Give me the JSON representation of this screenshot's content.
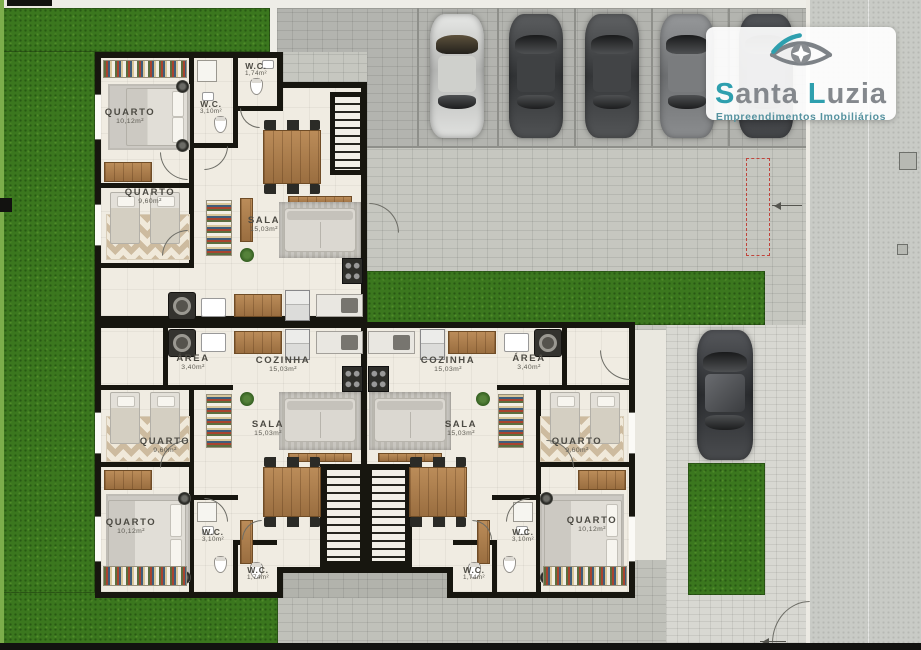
{
  "brand": {
    "word1": "Santa",
    "word2": "Luzia",
    "tagline": "Empreendimentos Imobiliários",
    "accent_color": "#2e9fae",
    "text_color": "#84888d"
  },
  "rooms": {
    "t_quarto1": {
      "name": "QUARTO",
      "area": "10,12m²"
    },
    "t_quarto2": {
      "name": "QUARTO",
      "area": "9,60m²"
    },
    "t_wc_small": {
      "name": "W.C.",
      "area": "1,74m²"
    },
    "t_wc_large": {
      "name": "W.C.",
      "area": "3,10m²"
    },
    "t_sala": {
      "name": "SALA",
      "area": "15,03m²"
    },
    "bl_area": {
      "name": "ÁREA",
      "area": "3,40m²"
    },
    "bl_cozinha": {
      "name": "COZINHA",
      "area": "15,03m²"
    },
    "bl_sala": {
      "name": "SALA",
      "area": "15,03m²"
    },
    "bl_quarto1": {
      "name": "QUARTO",
      "area": "9,60m²"
    },
    "bl_quarto2": {
      "name": "QUARTO",
      "area": "10,12m²"
    },
    "bl_wc_large": {
      "name": "W.C.",
      "area": "3,10m²"
    },
    "bl_wc_small": {
      "name": "W.C.",
      "area": "1,74m²"
    },
    "br_cozinha": {
      "name": "COZINHA",
      "area": "15,03m²"
    },
    "br_area": {
      "name": "ÁREA",
      "area": "3,40m²"
    },
    "br_sala": {
      "name": "SALA",
      "area": "15,03m²"
    },
    "br_quarto1": {
      "name": "QUARTO",
      "area": "9,60m²"
    },
    "br_quarto2": {
      "name": "QUARTO",
      "area": "10,12m²"
    },
    "br_wc_large": {
      "name": "W.C.",
      "area": "3,10m²"
    },
    "br_wc_small": {
      "name": "W.C.",
      "area": "1,74m²"
    }
  },
  "palette": {
    "accent": "#2e9fae",
    "logo_gray": "#84888d",
    "wall": "#17160f",
    "floor": "#f0ece2",
    "wood": "#a97a4e",
    "grass": "#3b771e",
    "paver": "#c6c7c0",
    "road": "#c9cbc6"
  }
}
